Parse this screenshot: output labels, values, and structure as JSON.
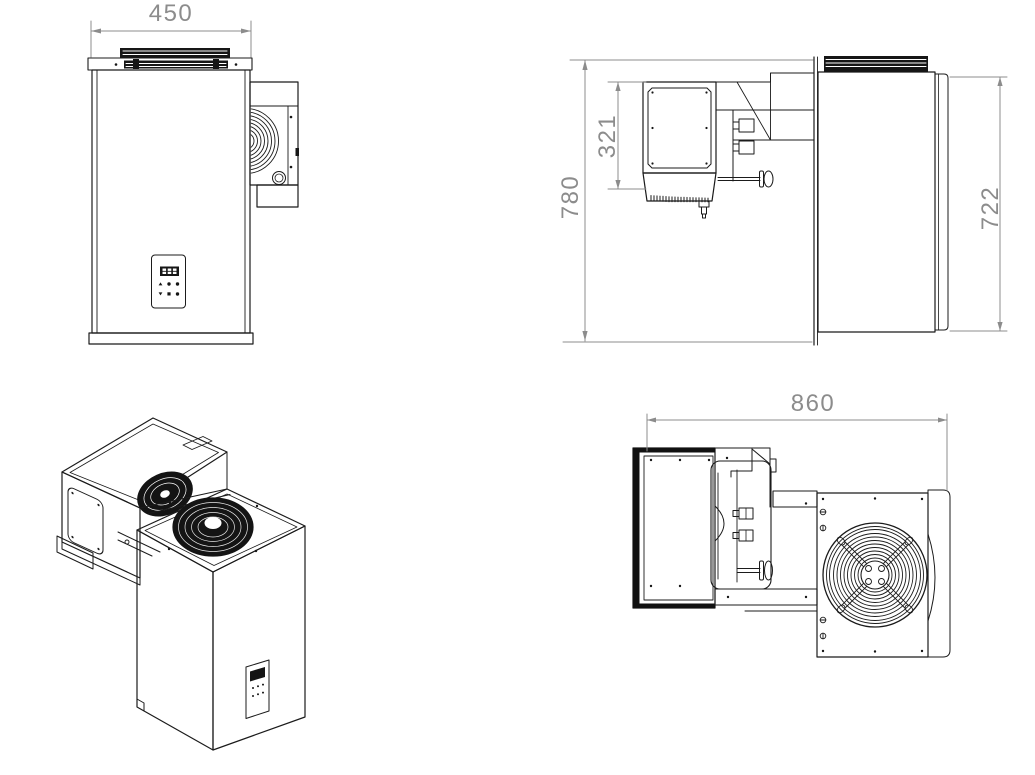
{
  "document": {
    "type": "technical-drawing",
    "subject": "Refrigeration monoblock cooling unit - four view dimensional drawing",
    "background_color": "#ffffff",
    "line_color": "#1b1b1b",
    "dimension_color": "#8c8c8c"
  },
  "views": {
    "front": {
      "name": "front-view",
      "dimensions": {
        "width": "450"
      },
      "graphics": [
        "top-grille",
        "control-panel",
        "seven-segment-display",
        "condenser-protrusion",
        "fan-arcs"
      ]
    },
    "side": {
      "name": "side-view",
      "dimensions": {
        "overall_height": "780",
        "evaporator_height": "321",
        "body_height": "722"
      },
      "graphics": [
        "evaporator-box",
        "drip-tray",
        "drain-fitting",
        "wall-section",
        "mounting-knob",
        "top-grille"
      ]
    },
    "isometric": {
      "name": "isometric-view",
      "graphics": [
        "axial-fan",
        "evaporator-impeller",
        "evaporator-panel",
        "control-panel"
      ]
    },
    "top": {
      "name": "top-view",
      "dimensions": {
        "overall_depth": "860"
      },
      "graphics": [
        "fan-guard",
        "mounting-brackets",
        "side-screws",
        "mounting-knob"
      ]
    }
  }
}
